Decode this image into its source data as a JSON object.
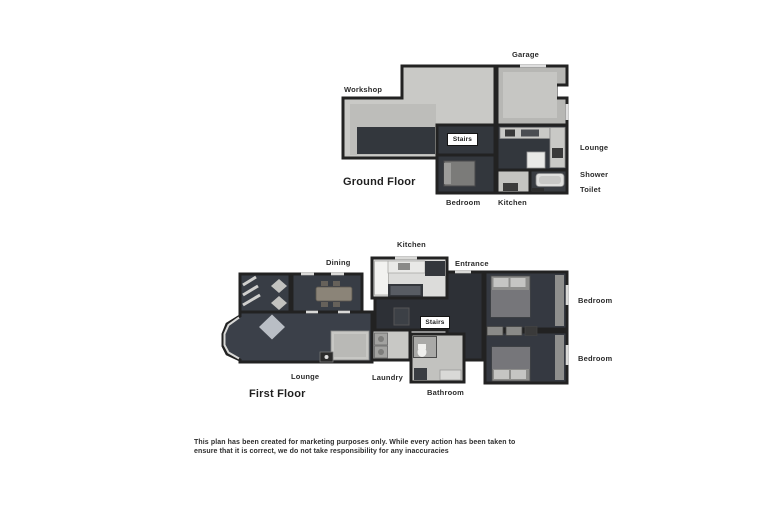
{
  "colors": {
    "wall": "#222222",
    "floor_dark": "#363a42",
    "floor_light": "#c6c6c3",
    "label_text": "#2b2b2b"
  },
  "ground_floor": {
    "title": "Ground Floor",
    "stairs": "Stairs",
    "labels": {
      "garage": "Garage",
      "workshop": "Workshop",
      "lounge": "Lounge",
      "shower": "Shower",
      "toilet": "Toilet",
      "bedroom": "Bedroom",
      "kitchen": "Kitchen"
    }
  },
  "first_floor": {
    "title": "First Floor",
    "stairs": "Stairs",
    "labels": {
      "kitchen": "Kitchen",
      "dining": "Dining",
      "entrance": "Entrance",
      "bedroom_top": "Bedroom",
      "bedroom_bottom": "Bedroom",
      "lounge": "Lounge",
      "laundry": "Laundry",
      "bathroom": "Bathroom"
    }
  },
  "disclaimer": {
    "line1": "This plan has been created for marketing purposes only. While every action has been taken to",
    "line2": "ensure that it is correct, we do not take responsibility for any inaccuracies"
  }
}
